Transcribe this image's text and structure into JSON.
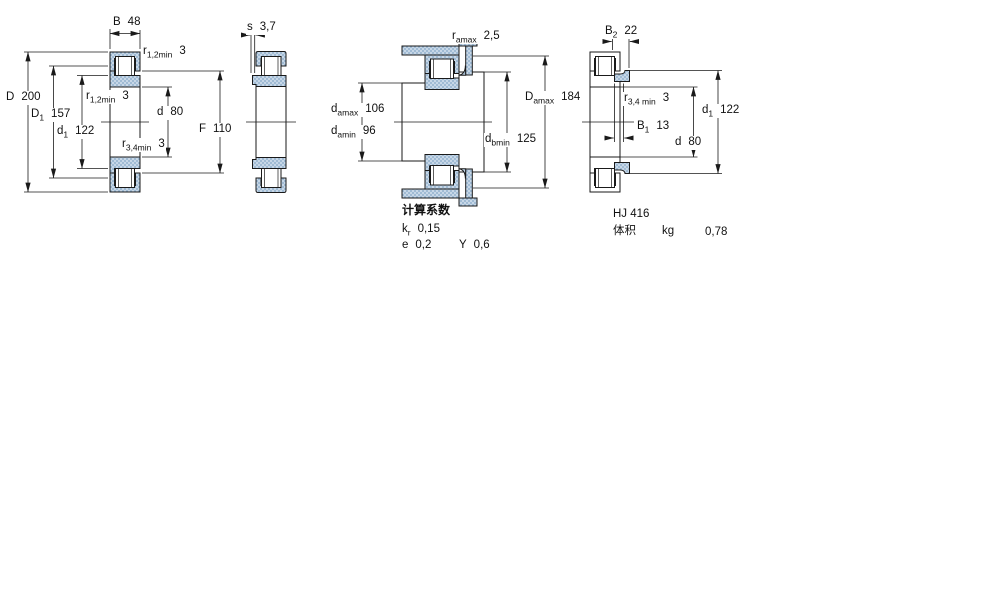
{
  "colors": {
    "line": "#1a1a1a",
    "fill_base": "#c7d7e7",
    "fill_dot": "#84a7c7",
    "white": "#ffffff"
  },
  "front": {
    "B": {
      "sym": "B",
      "val": "48"
    },
    "r12_top": {
      "sym": "r",
      "sub": "1,2min",
      "val": "3"
    },
    "D": {
      "sym": "D",
      "val": "200"
    },
    "D1": {
      "sym": "D",
      "sub": "1",
      "val": "157"
    },
    "d1": {
      "sym": "d",
      "sub": "1",
      "val": "122"
    },
    "r12_mid": {
      "sym": "r",
      "sub": "1,2min",
      "val": "3"
    },
    "d": {
      "sym": "d",
      "val": "80"
    },
    "F": {
      "sym": "F",
      "val": "110"
    },
    "r34": {
      "sym": "r",
      "sub": "3,4min",
      "val": "3"
    }
  },
  "side": {
    "s": {
      "sym": "s",
      "val": "3,7"
    }
  },
  "mounted": {
    "ra": {
      "sym": "r",
      "sub": "amax",
      "val": "2,5"
    },
    "da_max": {
      "sym": "d",
      "sub": "amax",
      "val": "106"
    },
    "da_min": {
      "sym": "d",
      "sub": "amin",
      "val": "96"
    },
    "Da_max": {
      "sym": "D",
      "sub": "amax",
      "val": "184"
    },
    "db_min": {
      "sym": "d",
      "sub": "bmin",
      "val": "125"
    }
  },
  "ring": {
    "B2": {
      "sym": "B",
      "sub": "2",
      "val": "22"
    },
    "r34": {
      "sym": "r",
      "sub": "3,4 min",
      "val": "3"
    },
    "B1": {
      "sym": "B",
      "sub": "1",
      "val": "13"
    },
    "d": {
      "sym": "d",
      "val": "80"
    },
    "d1": {
      "sym": "d",
      "sub": "1",
      "val": "122"
    }
  },
  "calc": {
    "title": "计算系数",
    "kr": {
      "sym": "k",
      "sub": "r",
      "val": "0,15"
    },
    "e": {
      "sym": "e",
      "val": "0,2"
    },
    "Y": {
      "sym": "Y",
      "val": "0,6"
    }
  },
  "ring_info": {
    "designation": "HJ 416",
    "mass_label": "体积",
    "mass_unit": "kg",
    "mass_value": "0,78"
  }
}
